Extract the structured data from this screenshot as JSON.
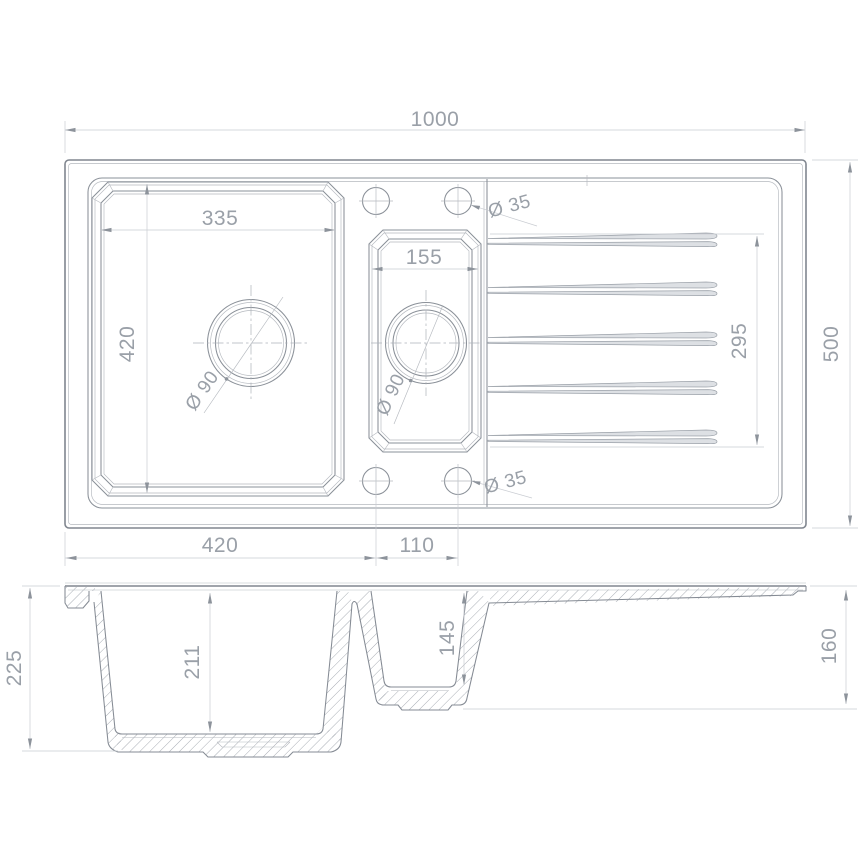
{
  "plan_view": {
    "overall_width": "1000",
    "overall_depth": "500",
    "main_bowl_width": "335",
    "main_bowl_length": "420",
    "main_bowl_drain": "Ø 90",
    "small_bowl_width": "155",
    "small_bowl_drain": "Ø 90",
    "drainer_groove_length": "295",
    "tap_hole_top": "Ø 35",
    "tap_hole_bottom": "Ø 35",
    "tap_hole_offset": "420",
    "tap_hole_spacing": "110"
  },
  "section_view": {
    "overall_height": "225",
    "main_bowl_depth": "211",
    "small_bowl_depth": "145",
    "drainer_edge_height": "160"
  },
  "colors": {
    "background": "#ffffff",
    "line_primary": "#80868f",
    "line_secondary": "#b5b9bf",
    "dimension_line": "#c9ccd2",
    "text": "#9aa0a8",
    "hatch": "#9aa0a8"
  }
}
